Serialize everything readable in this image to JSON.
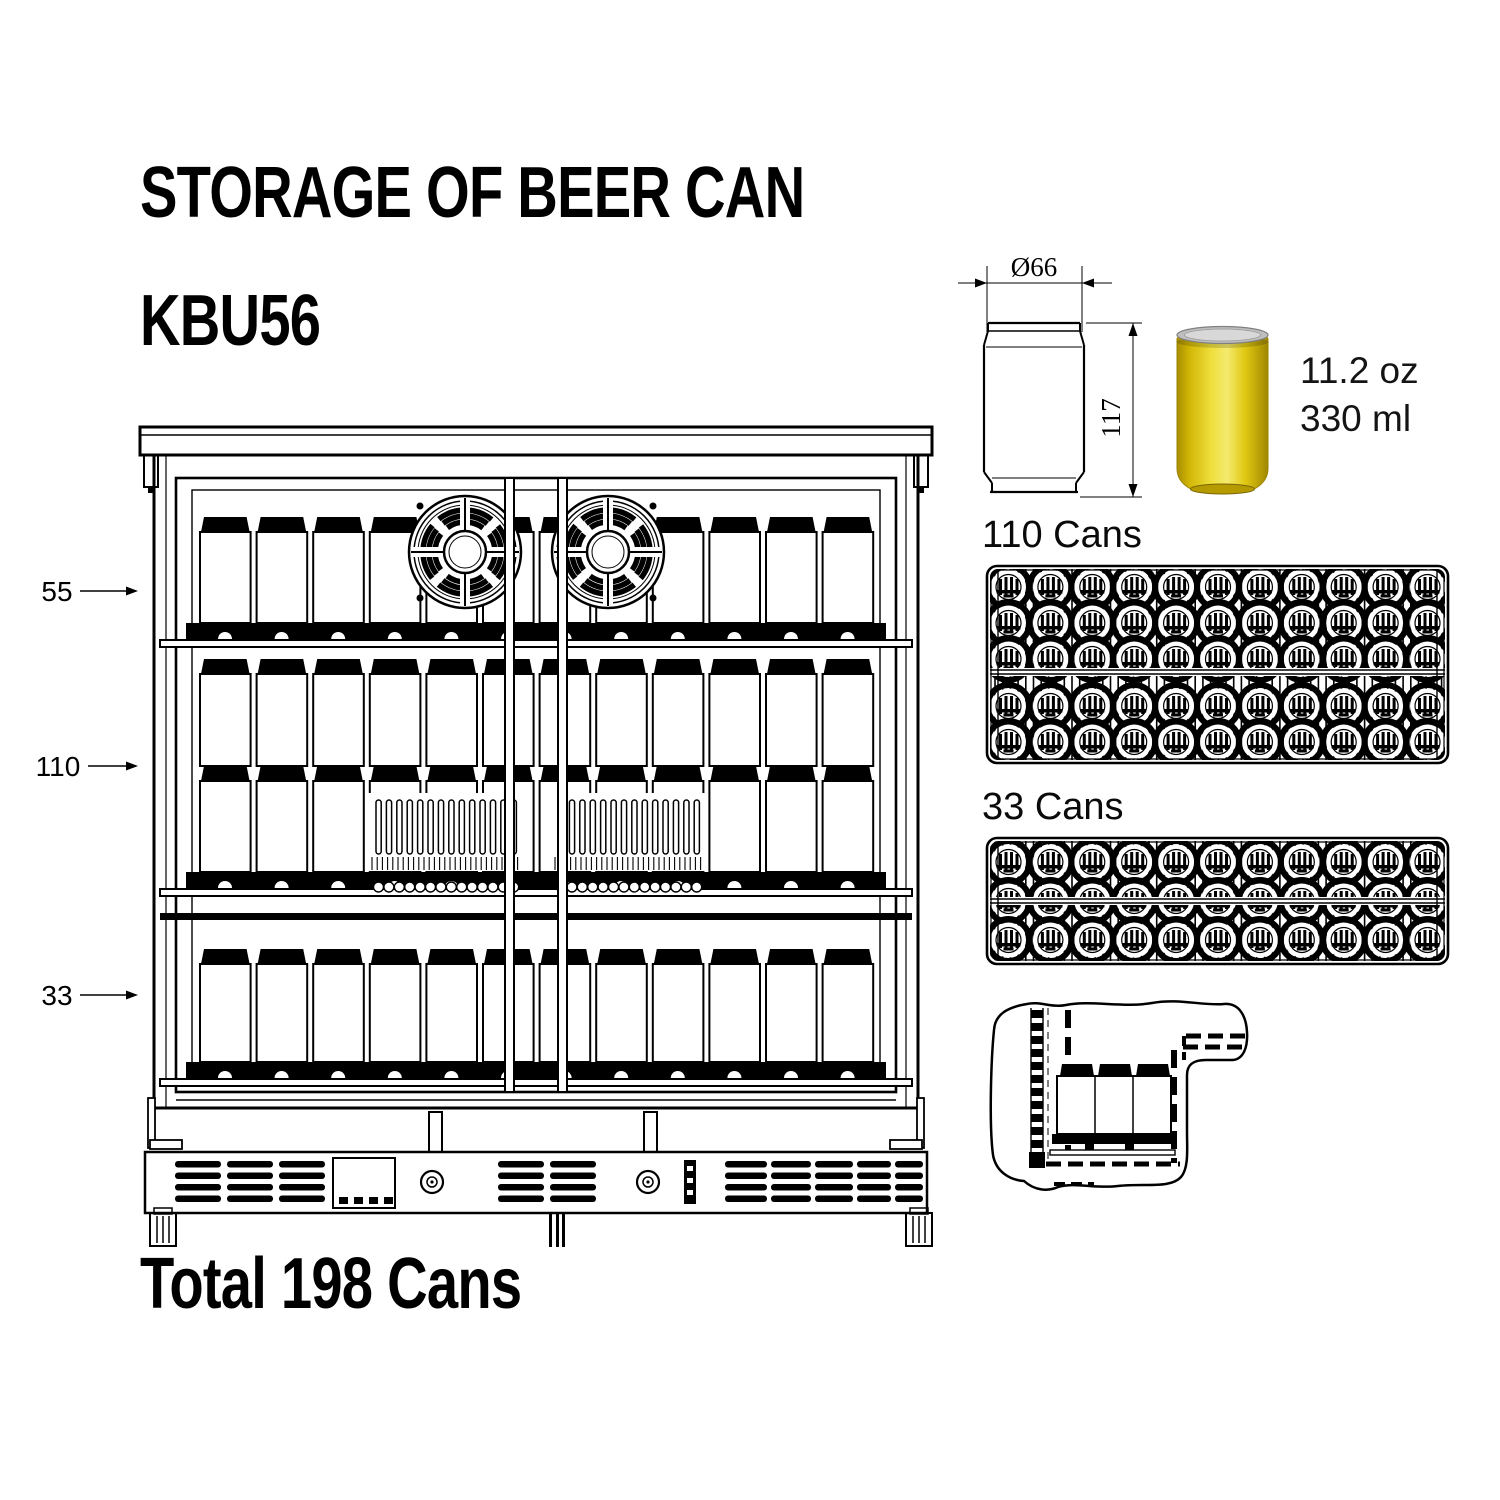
{
  "title": "STORAGE OF BEER CAN",
  "model": "KBU56",
  "total_label": "Total 198 Cans",
  "fridge_dims": {
    "top_shelf": "55",
    "middle_shelf": "110",
    "bottom_shelf": "33"
  },
  "can_spec": {
    "diameter_label": "Ø66",
    "height_label": "117",
    "volume_oz": "11.2 oz",
    "volume_ml": "330 ml",
    "can_color": "#e8cd0e"
  },
  "tray1_label": "110 Cans",
  "tray2_label": "33 Cans"
}
